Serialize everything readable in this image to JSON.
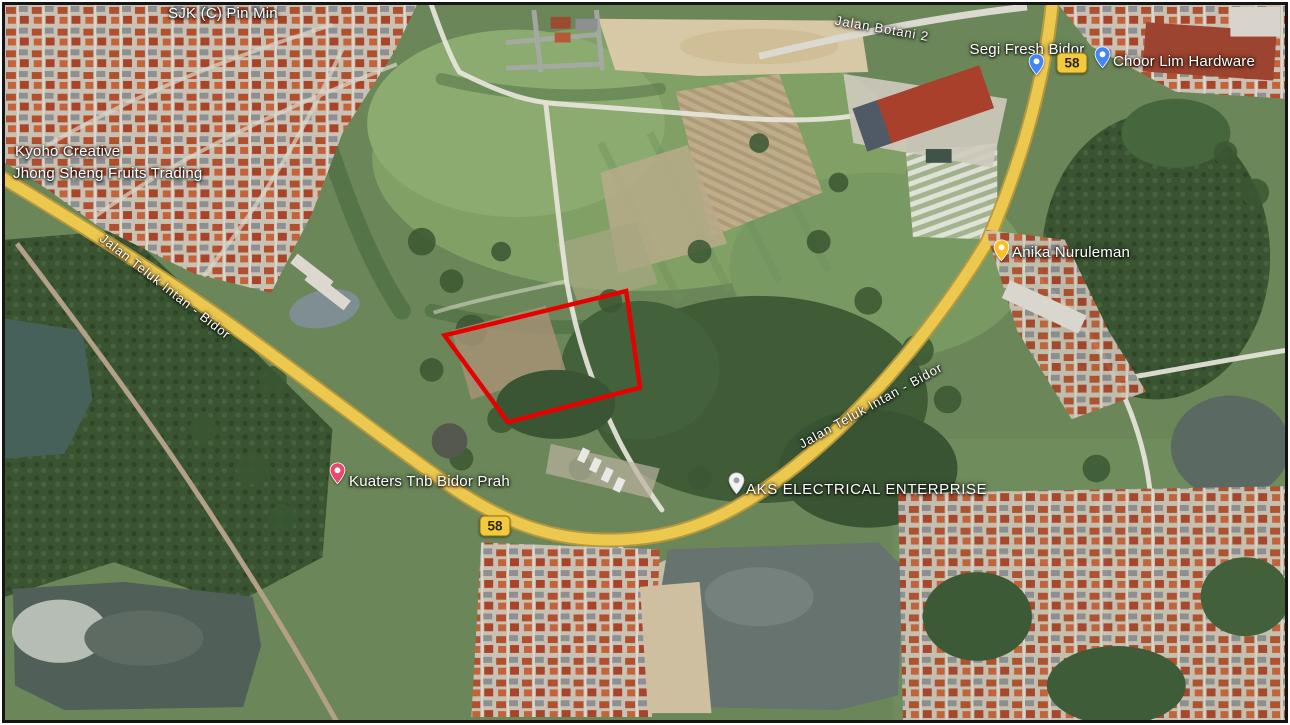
{
  "map": {
    "view_type": "satellite",
    "places": [
      {
        "name": "SJK (C) Pin Min"
      },
      {
        "name": "Kyoho Creative"
      },
      {
        "name": "Jhong Sheng Fruits Trading"
      },
      {
        "name": "Segi Fresh Bidor",
        "pin_color": "#4285f4"
      },
      {
        "name": "Choor Lim Hardware",
        "pin_color": "#4285f4"
      },
      {
        "name": "Anika Nuruleman",
        "pin_color": "#fbbf1f"
      },
      {
        "name": "Kuaters Tnb Bidor Prah",
        "pin_color": "#e8486e"
      },
      {
        "name": "AKS ELECTRICAL ENTERPRISE",
        "pin_color": "#f1f3f4"
      }
    ],
    "road_labels": [
      {
        "name": "Jalan Botani 2"
      },
      {
        "name": "Jalan Teluk Intan - Bidor"
      },
      {
        "name": "Jalan Teluk Intan - Bidor"
      }
    ],
    "route_shields": [
      {
        "number": "58"
      },
      {
        "number": "58"
      }
    ],
    "parcel_outline": {
      "color": "#e60000",
      "shape": "quadrilateral",
      "points": "626,290 443,335 507,423 640,388"
    }
  }
}
